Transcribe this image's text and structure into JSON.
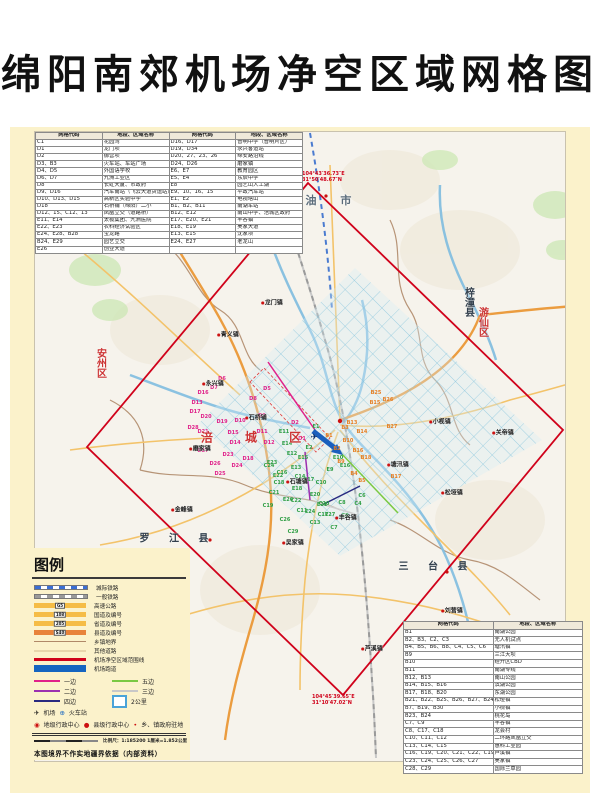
{
  "page": {
    "title": "绵阳南郊机场净空区域网格图"
  },
  "top_table": {
    "headers": [
      "网格代码",
      "地段、区域名称",
      "网格代码",
      "地段、区域名称"
    ],
    "rows": [
      [
        "C1",
        "花园湾",
        "D16、D17",
        "普明中学（普明片区）"
      ],
      [
        "D1",
        "龙门坝",
        "D19、D34",
        "永兴客运站"
      ],
      [
        "D2",
        "御营坝",
        "D20、27、23、26",
        "绵安路沿线"
      ],
      [
        "D3、B3",
        "火车站、车站广场",
        "D24、D26",
        "磨家镇"
      ],
      [
        "D4、D5",
        "外国语学校",
        "E6、E7",
        "教育园区"
      ],
      [
        "D6、D7",
        "九洲工业区",
        "E5、E4",
        "东辰中学"
      ],
      [
        "D8",
        "长虹大厦、市政府",
        "E8",
        "园艺山人工湖"
      ],
      [
        "D9、D16",
        "汽车南站（飞云大道货运站）",
        "E9、10、16、15",
        "平政汽车站"
      ],
      [
        "D10、D13、D15",
        "高新区实验中学",
        "E1、E2",
        "电视塔山"
      ],
      [
        "D18",
        "石桥铺（绵阳）二小",
        "B1、B2、B11",
        "南湖车站"
      ],
      [
        "D12、15、C12、13",
        "凤凰立交（道路桥）",
        "B12、E12",
        "南山中学、涪城区政府"
      ],
      [
        "E11、E14",
        "太极集团、九洲医院",
        "E17、E20、E21",
        "丰谷镇"
      ],
      [
        "E22、E23",
        "农科经济试验区",
        "E18、E19",
        "吴家大道"
      ],
      [
        "E24、E28、B28",
        "宝龙路",
        "E13、E15",
        "沈家坝"
      ],
      [
        "B24、E29",
        "园艺立交",
        "E24、E27",
        "老龙山"
      ],
      [
        "E26",
        "创业大道",
        "",
        ""
      ]
    ]
  },
  "bottom_table": {
    "headers": [
      "网格代码",
      "地段、区域名称"
    ],
    "rows": [
      [
        "B1",
        "南湖公园"
      ],
      [
        "B2、B3、C2、C3",
        "无人机试点"
      ],
      [
        "B4、B5、B6、B8、C4、C5、C6",
        "塘汛镇"
      ],
      [
        "B9",
        "三江大坝"
      ],
      [
        "B10",
        "经开区CBD"
      ],
      [
        "B11",
        "南湖专线"
      ],
      [
        "B12、B13",
        "南山公园"
      ],
      [
        "B14、B15、B16",
        "滨湖公园"
      ],
      [
        "B17、B18、B20",
        "东湖公园"
      ],
      [
        "B21、B22、B25、B26、B27、B24、B29",
        "松垭镇"
      ],
      [
        "B7、B19、B30",
        "小枧镇"
      ],
      [
        "B23、B24",
        "桃花岛"
      ],
      [
        "C7、C9",
        "丰谷镇"
      ],
      [
        "C8、C17、C18",
        "龙会村"
      ],
      [
        "C10、C11、C12",
        "二环路凤凰立交"
      ],
      [
        "C13、C14、C15",
        "惠科工业园"
      ],
      [
        "C16、C19、C20、C21、C22、C19",
        "芦溪镇"
      ],
      [
        "C23、C24、C25、C26、C27",
        "吴家镇"
      ],
      [
        "C28、C29",
        "国际兰草园"
      ]
    ]
  },
  "legend": {
    "title": "图例",
    "items": [
      {
        "label": "城际铁路",
        "type": "rail-blue"
      },
      {
        "label": "一般铁路",
        "type": "rail-gray"
      },
      {
        "label": "高速公路",
        "type": "road-yellow",
        "badge": "G5"
      },
      {
        "label": "国道及编号",
        "type": "road-yellow",
        "badge": "108"
      },
      {
        "label": "省道及编号",
        "type": "road-yellow",
        "badge": "205"
      },
      {
        "label": "县道及编号",
        "type": "road-orange",
        "badge": "S40"
      },
      {
        "label": "乡镇地界",
        "type": "line-brown"
      },
      {
        "label": "其他道路",
        "type": "line-tan"
      },
      {
        "label": "机场净空区域范围线",
        "type": "line-red"
      },
      {
        "label": "机场跑道",
        "type": "bar-blue"
      }
    ],
    "pattern_legs": [
      {
        "label": "一边",
        "color": "#e0218a"
      },
      {
        "label": "五边",
        "color": "#7ac943"
      },
      {
        "label": "二边",
        "color": "#9b30b0"
      },
      {
        "label": "三边",
        "color": "#c8c8c8"
      },
      {
        "label": "四边",
        "color": "#2a2a80"
      },
      {
        "label": "2公里",
        "box": true
      }
    ],
    "symbols": {
      "airport_icon": "✈",
      "airport_label": "机场",
      "train_icon": "⊕",
      "train_label": "火车站",
      "admin_city_icon": "◉",
      "admin_city_label": "地级行政中心",
      "admin_county_icon": "●",
      "admin_county_label": "县级行政中心",
      "admin_town_icon": "•",
      "admin_town_label": "乡、镇政府驻地"
    },
    "scale_text": "比例尺：1:185200 1厘米=1.852公里",
    "note": "本图境界不作实地疆界依据（内部资料）"
  },
  "map": {
    "boundary_color": "#d0021b",
    "grid_colors": {
      "D": "#e0218a",
      "E": "#2e9e44",
      "B": "#e67e22",
      "C": "#2e9e44"
    },
    "corner_coords": [
      {
        "x": 302,
        "y": 172,
        "lines": [
          "104°43′36.73″E",
          "31°50′48.67″N"
        ]
      },
      {
        "x": 312,
        "y": 695,
        "lines": [
          "104°45′39.65″E",
          "31°10′47.02″N"
        ]
      }
    ],
    "airport_symbol": {
      "glyph": "✈",
      "x": 314,
      "y": 438
    },
    "region_labels": [
      {
        "text": "江 油 市",
        "x": 316,
        "y": 200,
        "color": "#5a6b7a",
        "size": 11,
        "spacing": 10
      },
      {
        "text": "安州区",
        "x": 100,
        "y": 363,
        "color": "#cc3333",
        "size": 10,
        "vertical": true
      },
      {
        "text": "涪 城 区",
        "x": 258,
        "y": 437,
        "color": "#cc3333",
        "size": 12,
        "spacing": 14
      },
      {
        "text": "游仙区",
        "x": 482,
        "y": 322,
        "color": "#cc3333",
        "size": 10,
        "vertical": true
      },
      {
        "text": "梓潼县",
        "x": 468,
        "y": 302,
        "color": "#33404d",
        "size": 10,
        "vertical": true
      },
      {
        "text": "罗 江 县",
        "x": 178,
        "y": 537,
        "color": "#33404d",
        "size": 10,
        "spacing": 8
      },
      {
        "text": "三 台 县",
        "x": 437,
        "y": 565,
        "color": "#33404d",
        "size": 10,
        "spacing": 8
      }
    ],
    "town_labels": [
      {
        "text": "龙门镇",
        "x": 272,
        "y": 302
      },
      {
        "text": "青义镇",
        "x": 228,
        "y": 334
      },
      {
        "text": "永兴镇",
        "x": 213,
        "y": 383
      },
      {
        "text": "石桥铺",
        "x": 256,
        "y": 417
      },
      {
        "text": "磨家镇",
        "x": 200,
        "y": 448
      },
      {
        "text": "石塘镇",
        "x": 297,
        "y": 481
      },
      {
        "text": "塘汛镇",
        "x": 398,
        "y": 464
      },
      {
        "text": "小枧镇",
        "x": 440,
        "y": 421
      },
      {
        "text": "关帝镇",
        "x": 503,
        "y": 432
      },
      {
        "text": "松垭镇",
        "x": 452,
        "y": 492
      },
      {
        "text": "丰谷镇",
        "x": 346,
        "y": 517
      },
      {
        "text": "金峰镇",
        "x": 182,
        "y": 509
      },
      {
        "text": "吴家镇",
        "x": 293,
        "y": 542
      },
      {
        "text": "芦溪镇",
        "x": 372,
        "y": 648
      },
      {
        "text": "刘营镇",
        "x": 452,
        "y": 610
      }
    ],
    "grid_labels": [
      {
        "t": "D6",
        "x": 222,
        "y": 379
      },
      {
        "t": "D7",
        "x": 214,
        "y": 388
      },
      {
        "t": "D5",
        "x": 267,
        "y": 389
      },
      {
        "t": "D16",
        "x": 203,
        "y": 393
      },
      {
        "t": "D8",
        "x": 253,
        "y": 399
      },
      {
        "t": "D13",
        "x": 197,
        "y": 403
      },
      {
        "t": "D17",
        "x": 195,
        "y": 412
      },
      {
        "t": "D20",
        "x": 206,
        "y": 417
      },
      {
        "t": "D9",
        "x": 262,
        "y": 416
      },
      {
        "t": "D10",
        "x": 240,
        "y": 421
      },
      {
        "t": "D19",
        "x": 222,
        "y": 422
      },
      {
        "t": "D2",
        "x": 295,
        "y": 423
      },
      {
        "t": "D28",
        "x": 193,
        "y": 428
      },
      {
        "t": "D21",
        "x": 203,
        "y": 432
      },
      {
        "t": "D15",
        "x": 233,
        "y": 433
      },
      {
        "t": "D11",
        "x": 262,
        "y": 432
      },
      {
        "t": "D1",
        "x": 302,
        "y": 439
      },
      {
        "t": "D14",
        "x": 235,
        "y": 443
      },
      {
        "t": "D12",
        "x": 269,
        "y": 443
      },
      {
        "t": "D27",
        "x": 203,
        "y": 451
      },
      {
        "t": "D23",
        "x": 228,
        "y": 455
      },
      {
        "t": "D18",
        "x": 248,
        "y": 459
      },
      {
        "t": "D26",
        "x": 215,
        "y": 464
      },
      {
        "t": "D24",
        "x": 237,
        "y": 466
      },
      {
        "t": "D25",
        "x": 220,
        "y": 474
      },
      {
        "t": "E1",
        "x": 316,
        "y": 427
      },
      {
        "t": "E11",
        "x": 284,
        "y": 432
      },
      {
        "t": "E14",
        "x": 287,
        "y": 444
      },
      {
        "t": "E12",
        "x": 292,
        "y": 454
      },
      {
        "t": "E15",
        "x": 303,
        "y": 458
      },
      {
        "t": "E2",
        "x": 309,
        "y": 448
      },
      {
        "t": "E13",
        "x": 296,
        "y": 468
      },
      {
        "t": "E9",
        "x": 330,
        "y": 470
      },
      {
        "t": "E10",
        "x": 338,
        "y": 458
      },
      {
        "t": "E16",
        "x": 345,
        "y": 466
      },
      {
        "t": "E17",
        "x": 309,
        "y": 480
      },
      {
        "t": "E18",
        "x": 297,
        "y": 489
      },
      {
        "t": "E20",
        "x": 315,
        "y": 495
      },
      {
        "t": "E21",
        "x": 322,
        "y": 505
      },
      {
        "t": "E22",
        "x": 278,
        "y": 476
      },
      {
        "t": "E23",
        "x": 272,
        "y": 463
      },
      {
        "t": "E24",
        "x": 310,
        "y": 512
      },
      {
        "t": "E26",
        "x": 288,
        "y": 500
      },
      {
        "t": "E27",
        "x": 330,
        "y": 515
      },
      {
        "t": "B25",
        "x": 376,
        "y": 393
      },
      {
        "t": "B26",
        "x": 388,
        "y": 400
      },
      {
        "t": "B15",
        "x": 375,
        "y": 403
      },
      {
        "t": "B13",
        "x": 352,
        "y": 423
      },
      {
        "t": "B27",
        "x": 392,
        "y": 427
      },
      {
        "t": "B3",
        "x": 345,
        "y": 428
      },
      {
        "t": "B14",
        "x": 362,
        "y": 432
      },
      {
        "t": "B1",
        "x": 329,
        "y": 436
      },
      {
        "t": "B10",
        "x": 348,
        "y": 441
      },
      {
        "t": "B2",
        "x": 337,
        "y": 449
      },
      {
        "t": "B16",
        "x": 358,
        "y": 451
      },
      {
        "t": "B18",
        "x": 366,
        "y": 458
      },
      {
        "t": "B9",
        "x": 341,
        "y": 462
      },
      {
        "t": "B4",
        "x": 354,
        "y": 474
      },
      {
        "t": "B17",
        "x": 396,
        "y": 477
      },
      {
        "t": "B5",
        "x": 362,
        "y": 481
      },
      {
        "t": "C24",
        "x": 269,
        "y": 466
      },
      {
        "t": "C16",
        "x": 282,
        "y": 473
      },
      {
        "t": "C14",
        "x": 300,
        "y": 477
      },
      {
        "t": "C18",
        "x": 279,
        "y": 483
      },
      {
        "t": "C10",
        "x": 321,
        "y": 483
      },
      {
        "t": "C21",
        "x": 274,
        "y": 493
      },
      {
        "t": "C6",
        "x": 362,
        "y": 496
      },
      {
        "t": "C22",
        "x": 296,
        "y": 501
      },
      {
        "t": "C8",
        "x": 342,
        "y": 503
      },
      {
        "t": "C20",
        "x": 324,
        "y": 504
      },
      {
        "t": "C19",
        "x": 268,
        "y": 506
      },
      {
        "t": "C4",
        "x": 358,
        "y": 504
      },
      {
        "t": "C11",
        "x": 302,
        "y": 511
      },
      {
        "t": "C17",
        "x": 323,
        "y": 515
      },
      {
        "t": "C9",
        "x": 345,
        "y": 516
      },
      {
        "t": "C26",
        "x": 285,
        "y": 520
      },
      {
        "t": "C13",
        "x": 315,
        "y": 523
      },
      {
        "t": "C7",
        "x": 334,
        "y": 528
      },
      {
        "t": "C29",
        "x": 293,
        "y": 532
      }
    ]
  }
}
